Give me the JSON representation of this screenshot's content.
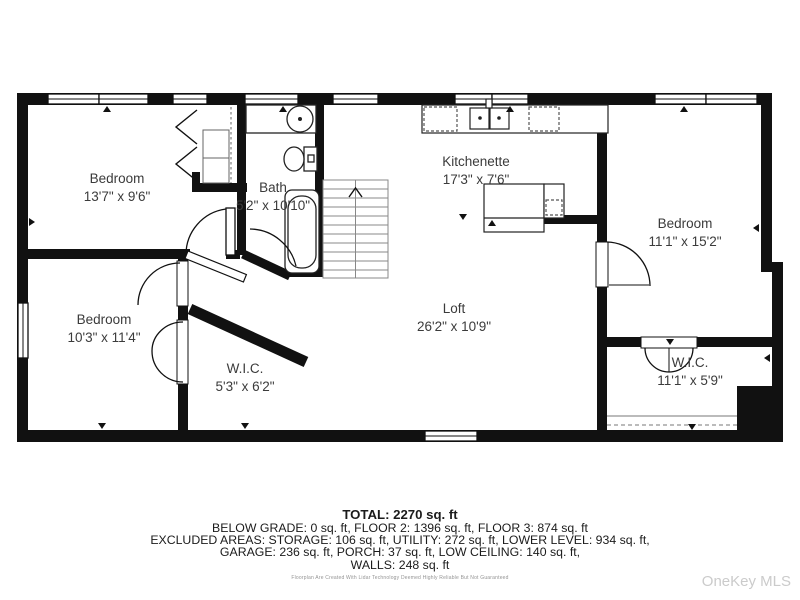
{
  "floorplan": {
    "rooms": [
      {
        "name": "Bedroom",
        "dims": "13'7\" x 9'6\""
      },
      {
        "name": "Bath",
        "dims": "5'2\" x 10'10\""
      },
      {
        "name": "Kitchenette",
        "dims": "17'3\" x 7'6\""
      },
      {
        "name": "Bedroom",
        "dims": "11'1\" x 15'2\""
      },
      {
        "name": "Bedroom",
        "dims": "10'3\" x 11'4\""
      },
      {
        "name": "W.I.C.",
        "dims": "5'3\" x 6'2\""
      },
      {
        "name": "Loft",
        "dims": "26'2\" x 10'9\""
      },
      {
        "name": "W.I.C.",
        "dims": "11'1\" x 5'9\""
      }
    ]
  },
  "summary": {
    "total": "TOTAL: 2270 sq. ft",
    "lines": [
      "BELOW GRADE: 0 sq. ft, FLOOR 2: 1396 sq. ft, FLOOR 3: 874 sq. ft",
      "EXCLUDED AREAS: STORAGE: 106 sq. ft, UTILITY: 272 sq. ft, LOWER LEVEL: 934 sq. ft,",
      "GARAGE: 236 sq. ft, PORCH: 37 sq. ft, LOW CEILING: 140 sq. ft,",
      "WALLS: 248 sq. ft"
    ]
  },
  "disclaimer": "Floorplan Are Created With Lidar Technology Deemed Highly Reliable But Not Guaranteed",
  "watermark": "OneKey MLS",
  "colors": {
    "wall": "#111111",
    "background": "#ffffff",
    "label_text": "#3b3b3b",
    "watermark_text": "#cbcbcb"
  }
}
